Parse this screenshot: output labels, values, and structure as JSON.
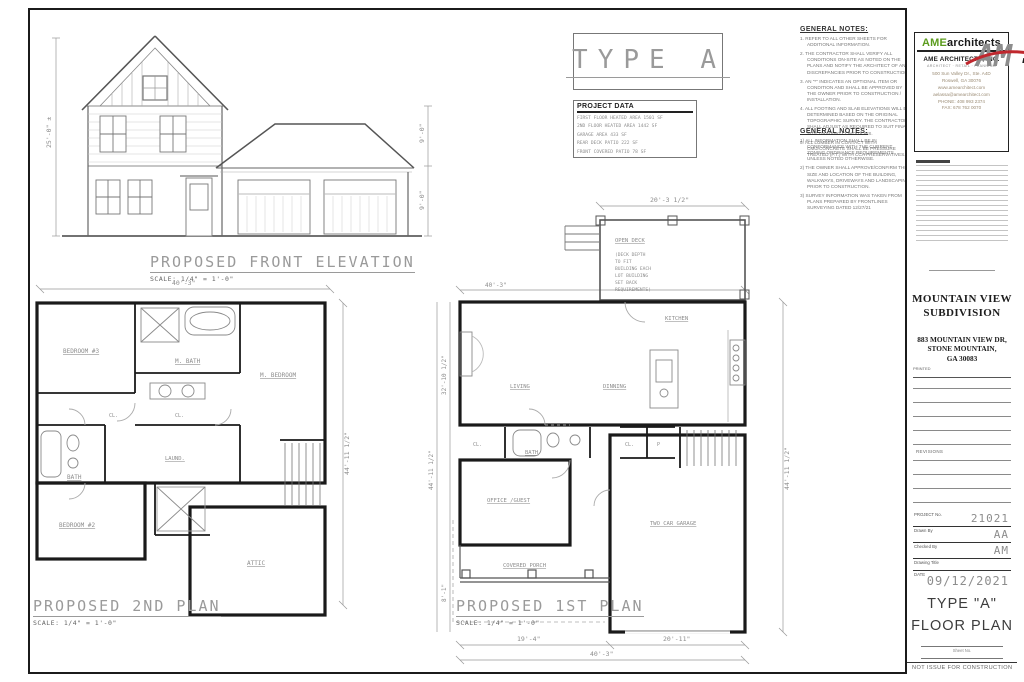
{
  "type_box": {
    "label": "TYPE A"
  },
  "project_data": {
    "title": "PROJECT DATA",
    "lines": [
      "FIRST FLOOR HEATED AREA 1501 SF",
      "2ND FLOOR HEATED AREA 1442 SF",
      "GARAGE AREA 433 SF",
      "REAR DECK PATIO 222 SF",
      "FRONT COVERED PATIO 78 SF"
    ]
  },
  "general_notes_top": {
    "title": "GENERAL NOTES:",
    "items": [
      "1. REFER TO ALL OTHER SHEETS FOR ADDITIONAL INFORMATION.",
      "2. THE CONTRACTOR SHALL VERIFY ALL CONDITIONS ON-SITE AS NOTED ON THE PLANS AND NOTIFY THE ARCHITECT OF ANY DISCREPANCIES PRIOR TO CONSTRUCTION.",
      "3. AN \"*\" INDICATES AN OPTIONAL ITEM OR CONDITION AND SHALL BE APPROVED BY THE OWNER PRIOR TO CONSTRUCTION / INSTALLATION.",
      "4. ALL FOOTING AND SLAB ELEVATIONS WILL BE DETERMINED BASED ON THE ORIGINAL TOPOGRAPHIC SURVEY. THE CONTRACTOR SHALL ADJUST AS REQUIRED TO SUIT FINAL SITE GRADING CONDITIONS.",
      "5. ALL LUMBER IN CONTACT WITH CMU/CONCRETE SHALL BE PRESSURE TREATED (P.T.) WITH CCA PRESERVATIVES."
    ]
  },
  "general_notes_mid": {
    "title": "GENERAL NOTES:",
    "items": [
      "1) ALL INFORMATION SHALL BE IN CONFORMANCE WITH THE CURRENT ZONING ORDINANCE REQUIREMENTS UNLESS NOTED OTHERWISE.",
      "2) THE OWNER SHALL APPROVE/CONFIRM THE SIZE AND LOCATION OF THE BUILDING, WALKWAYS, DRIVEWAYS AND LANDSCAPING PRIOR TO CONSTRUCTION.",
      "3) SURVEY INFORMATION WAS TAKEN FROM PLANS PREPARED BY FRONTLINES SURVEYING DATED 12/27/21"
    ]
  },
  "firm": {
    "logo_ame": "AME",
    "logo_architects": "architects",
    "name": "AME ARCHITECTS, INC.",
    "tagline": "ARCHITECT · RETAIL · PLANNING",
    "address1": "500 Sun Valley Dr., Ste. A4D",
    "address2": "Roswell, GA 30076",
    "website": "www.amearchitect.com",
    "email": "aelassa@amearchitect.com",
    "phone": "PHONE: 408 993 2374",
    "fax": "FAX: 678 762 0070"
  },
  "subdivision": {
    "name_line1": "MOUNTAIN VIEW",
    "name_line2": "SUBDIVISION",
    "address_line1": "883 MOUNTAIN VIEW DR,",
    "address_line2": "STONE MOUNTAIN,",
    "address_line3": "GA 30083",
    "printed_label": "PRINTED"
  },
  "revisions": {
    "label": "REVISIONS"
  },
  "titleblock": {
    "project_label": "PROJECT No.",
    "project_number": "21021",
    "drawn_label": "Drawn By",
    "drawn_by": "AA",
    "checked_label": "Checked By",
    "checked_by": "AM",
    "drawing_title_label": "Drawing Title",
    "date_label": "DATE",
    "date": "09/12/2021",
    "sheet_title_line1": "TYPE \"A\"",
    "sheet_title_line2": "FLOOR PLAN",
    "sheet_no_label": "Sheet No.",
    "footer": "NOT ISSUE FOR CONSTRUCTION"
  },
  "elevation": {
    "title": "PROPOSED FRONT ELEVATION",
    "scale": "SCALE: 1/4\" = 1'-0\"",
    "dim_left": "25'-0\" ±",
    "dim_right_upper": "9'-0\"",
    "dim_right_lower": "9'-0\""
  },
  "plan2": {
    "title": "PROPOSED 2ND PLAN",
    "scale": "SCALE: 1/4\" = 1'-0\"",
    "dim_top": "40'-3\"",
    "dim_right": "44'-11 1/2\"",
    "rooms": {
      "bedroom3": "BEDROOM #3",
      "mbath": "M. BATH",
      "mbedroom": "M. BEDROOM",
      "cl1": "CL.",
      "cl2": "CL.",
      "bath": "BATH",
      "bedroom2": "BEDROOM #2",
      "laund": "LAUND.",
      "attic": "ATTIC"
    }
  },
  "plan1": {
    "title": "PROPOSED 1ST PLAN",
    "scale": "SCALE: 1/4\" = 1'-0\"",
    "dims": {
      "deck_width": "20'-3 1/2\"",
      "body_width_top": "40'-3\"",
      "left_upper": "32'-10 1/2\"",
      "left_outer": "44'-11 1/2\"",
      "left_lower": "8'-1\"",
      "right": "44'-11 1/2\"",
      "bottom_left": "19'-4\"",
      "bottom_right": "20'-11\"",
      "bottom_total": "40'-3\""
    },
    "rooms": {
      "open_deck": "OPEN DECK",
      "deck_note": [
        "(DECK DEPTH",
        "TO FIT",
        "BUILDING EACH",
        "LOT BUILDING",
        "SET BACK",
        "REQUIREMENTS)"
      ],
      "kitchen": "KITCHEN",
      "living": "LIVING",
      "dinning": "DINNING",
      "cl1": "CL.",
      "bath": "BATH",
      "cl2": "CL.",
      "pantry": "P",
      "office": "OFFICE /GUEST",
      "porch": "COVERED PORCH",
      "garage": "TWO CAR GARAGE"
    }
  }
}
